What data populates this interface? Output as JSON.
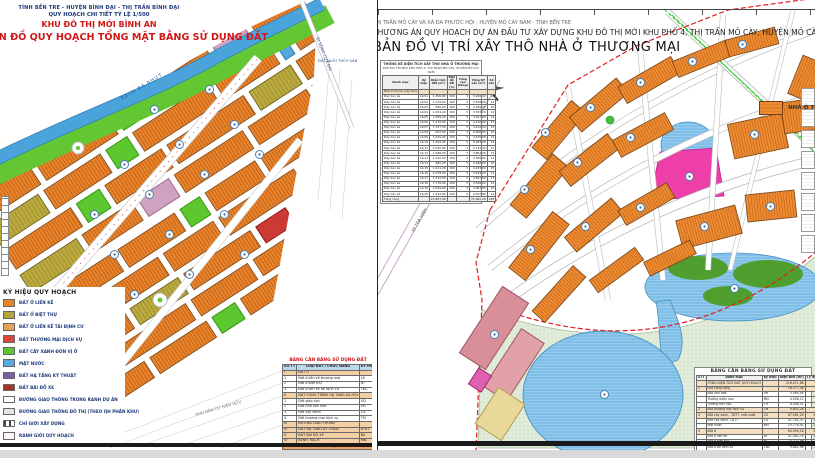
{
  "left_map": {
    "header": {
      "line1": "TỈNH BẾN TRE - HUYỆN BÌNH ĐẠI - THỊ TRẤN BÌNH ĐẠI",
      "line2": "QUY HOẠCH CHI TIẾT TỶ LỆ 1/500",
      "line3": "KHU ĐÔ THỊ MỚI BÌNH AN",
      "line4": "BẢN ĐỒ QUY HOẠCH TỔNG MẶT BẰNG SỬ DỤNG ĐẤT"
    },
    "labels": {
      "river": "RẠCH BÀ NHỰT",
      "road_top": "ĐI SÔNG CỬA ĐẠI",
      "aqua_land": "ĐẤT NUÔI THỦY SẢN",
      "existing": "KHU DÂN CƯ HIỆN HỮU"
    },
    "legend": {
      "title": "KÝ HIỆU QUY HOẠCH",
      "items": [
        {
          "label": "ĐẤT Ở LIỀN KỀ",
          "color": "#e8832b"
        },
        {
          "label": "ĐẤT Ở BIỆT THỰ",
          "color": "#b5a43c"
        },
        {
          "label": "ĐẤT Ở LIỀN KỀ TÁI ĐỊNH CƯ",
          "color": "#e6a258"
        },
        {
          "label": "ĐẤT THƯƠNG MẠI DỊCH VỤ",
          "color": "#d9483b"
        },
        {
          "label": "ĐẤT CÂY XANH ĐƠN VỊ Ở",
          "color": "#5cc72f"
        },
        {
          "label": "MẶT NƯỚC",
          "color": "#57a9dd"
        },
        {
          "label": "ĐẤT HẠ TẦNG KỸ THUẬT",
          "color": "#7c5fa8"
        },
        {
          "label": "ĐẤT BÃI ĐỖ XE",
          "color": "#a93226"
        },
        {
          "label": "ĐƯỜNG GIAO THÔNG TRONG RANH DỰ ÁN",
          "color": "#ffffff"
        },
        {
          "label": "ĐƯỜNG GIAO THÔNG ĐÔ THỊ (THEO QH PHÂN KHU)",
          "color": "#e4e4e4"
        },
        {
          "label": "CHỈ GIỚI XÂY DỰNG",
          "color": "repeating-linear-gradient(90deg,#444 0 2px,#fff 2px 5px)"
        },
        {
          "label": "RANH GIỚI QUY HOẠCH",
          "color": "#fff4f4"
        }
      ]
    },
    "table": {
      "title": "BẢNG CÂN BẰNG SỬ DỤNG ĐẤT",
      "headers": [
        "SỐ TT",
        "LOẠI ĐẤT / CHỨC NĂNG",
        "KÝ HIỆU"
      ],
      "rows": [
        {
          "tt": "I",
          "name": "ĐẤT Ở",
          "kh": "",
          "bg": "#f4cfa4"
        },
        {
          "tt": "1",
          "name": "Đất ở liền kề thương mại",
          "kh": "LK",
          "bg": ""
        },
        {
          "tt": "2",
          "name": "Đất ở biệt thự",
          "kh": "BT",
          "bg": ""
        },
        {
          "tt": "3",
          "name": "Đất ở liền kề tái định cư",
          "kh": "TĐC",
          "bg": ""
        },
        {
          "tt": "II",
          "name": "ĐẤT CÔNG TRÌNH HẠ TẦNG XÃ HỘI",
          "kh": "",
          "bg": "#f4cfa4"
        },
        {
          "tt": "1",
          "name": "Đất giáo dục",
          "kh": "GD",
          "bg": ""
        },
        {
          "tt": "2",
          "name": "Đất nhà văn hóa",
          "kh": "VH",
          "bg": ""
        },
        {
          "tt": "3",
          "name": "Đất cây xanh",
          "kh": "CX",
          "bg": ""
        },
        {
          "tt": "4",
          "name": "Đất thương mại dịch vụ",
          "kh": "TM",
          "bg": ""
        },
        {
          "tt": "III",
          "name": "ĐƯỜNG GIAO THÔNG",
          "kh": "",
          "bg": "#f4cfa4"
        },
        {
          "tt": "IV",
          "name": "ĐẤT HẠ TẦNG KỸ THUẬT",
          "kh": "HTKT",
          "bg": "#f4cfa4"
        },
        {
          "tt": "V",
          "name": "ĐẤT BÃI ĐỖ XE",
          "kh": "BX",
          "bg": "#f4cfa4"
        },
        {
          "tt": "VI",
          "name": "KÊNH, RẠCH",
          "kh": "MN",
          "bg": "#f4cfa4"
        }
      ],
      "footer": "TỔNG CỘNG"
    }
  },
  "right_map": {
    "header": {
      "line1": "THỊ TRẤN MỎ CÀY VÀ XÃ ĐA PHƯỚC HỘI - HUYỆN MỎ CÀY NAM - TỈNH BẾN TRE",
      "line2": "PHƯƠNG ÁN QUY HOẠCH DỰ ÁN ĐẦU TƯ XÂY DỰNG KHU ĐÔ THỊ MỚI KHU PHỐ 4, THỊ TRẤN MỎ CÀY, HUYỆN MỎ CÀY NAM",
      "line3": "BẢN ĐỒ VỊ TRÍ XÂY THÔ NHÀ Ở THƯƠNG MẠI"
    },
    "legend_label": "NHÀ Ở THƯƠNG MẠI",
    "road_label": "ĐI TÒA VỊNH",
    "top_table": {
      "caption1": "THỐNG KÊ DIỆN TÍCH XÂY THÔ NHÀ Ở THƯƠNG MẠI",
      "caption2": "KHU ĐÔ THỊ MỚI KHU PHỐ 4, THỊ TRẤN MỎ CÀY, HUYỆN MỎ CÀY NAM",
      "headers": [
        "Danh mục",
        "Ký hiệu",
        "Diện tích đất (m²)",
        "Mật độ XD (%)",
        "Tầng cao (tầng)",
        "Tổng DT sàn (m²)",
        "Số căn"
      ],
      "rows": [
        {
          "name": "Nhà ở liền kề (xây thô)",
          "kh": "",
          "dt": "",
          "md": "",
          "tc": "",
          "san": "",
          "can": "",
          "bg": "#f0e0c8"
        },
        {
          "name": "Dãy liền kề",
          "kh": "LK-01",
          "dt": "1.306,80",
          "md": "100",
          "tc": "3",
          "san": "3.920,40",
          "can": "13",
          "bg": ""
        },
        {
          "name": "Dãy liền kề",
          "kh": "LK-02",
          "dt": "1.176,00",
          "md": "100",
          "tc": "3",
          "san": "3.528,00",
          "can": "12",
          "bg": ""
        },
        {
          "name": "Dãy liền kề",
          "kh": "LK-03",
          "dt": "980,00",
          "md": "100",
          "tc": "3",
          "san": "2.940,00",
          "can": "10",
          "bg": ""
        },
        {
          "name": "Dãy liền kề",
          "kh": "LK-04",
          "dt": "1.254,40",
          "md": "100",
          "tc": "3",
          "san": "3.763,20",
          "can": "14",
          "bg": ""
        },
        {
          "name": "Dãy liền kề",
          "kh": "LK-05",
          "dt": "1.089,20",
          "md": "100",
          "tc": "3",
          "san": "3.267,60",
          "can": "11",
          "bg": ""
        },
        {
          "name": "Dãy liền kề",
          "kh": "LK-06",
          "dt": "1.470,00",
          "md": "100",
          "tc": "3",
          "san": "4.410,00",
          "can": "15",
          "bg": ""
        },
        {
          "name": "Dãy liền kề",
          "kh": "LK-07",
          "dt": "1.137,50",
          "md": "100",
          "tc": "3",
          "san": "3.412,50",
          "can": "12",
          "bg": ""
        },
        {
          "name": "Dãy liền kề",
          "kh": "LK-08",
          "dt": "952,00",
          "md": "100",
          "tc": "3",
          "san": "2.856,00",
          "can": "10",
          "bg": ""
        },
        {
          "name": "Dãy liền kề",
          "kh": "LK-09",
          "dt": "1.225,00",
          "md": "100",
          "tc": "3",
          "san": "3.675,00",
          "can": "13",
          "bg": ""
        },
        {
          "name": "Dãy liền kề",
          "kh": "LK-10",
          "dt": "1.394,40",
          "md": "100",
          "tc": "3",
          "san": "4.183,20",
          "can": "14",
          "bg": ""
        },
        {
          "name": "Dãy liền kề",
          "kh": "LK-11",
          "dt": "1.045,80",
          "md": "100",
          "tc": "3",
          "san": "3.137,40",
          "can": "11",
          "bg": ""
        },
        {
          "name": "Dãy liền kề",
          "kh": "LK-12",
          "dt": "1.288,00",
          "md": "100",
          "tc": "3",
          "san": "3.864,00",
          "can": "13",
          "bg": ""
        },
        {
          "name": "Dãy liền kề",
          "kh": "LK-13",
          "dt": "1.120,00",
          "md": "100",
          "tc": "3",
          "san": "3.360,00",
          "can": "12",
          "bg": ""
        },
        {
          "name": "Dãy liền kề",
          "kh": "LK-14",
          "dt": "980,00",
          "md": "100",
          "tc": "3",
          "san": "2.940,00",
          "can": "10",
          "bg": ""
        },
        {
          "name": "Dãy liền kề",
          "kh": "LK-15",
          "dt": "1.411,20",
          "md": "100",
          "tc": "3",
          "san": "4.233,60",
          "can": "15",
          "bg": ""
        },
        {
          "name": "Dãy liền kề",
          "kh": "LK-16",
          "dt": "1.078,00",
          "md": "100",
          "tc": "3",
          "san": "3.234,00",
          "can": "11",
          "bg": ""
        },
        {
          "name": "Dãy liền kề",
          "kh": "LK-17",
          "dt": "1.232,50",
          "md": "100",
          "tc": "3",
          "san": "3.697,50",
          "can": "13",
          "bg": ""
        },
        {
          "name": "Dãy liền kề",
          "kh": "LK-18",
          "dt": "1.176,00",
          "md": "100",
          "tc": "3",
          "san": "3.528,00",
          "can": "12",
          "bg": ""
        },
        {
          "name": "Dãy liền kề",
          "kh": "LK-19",
          "dt": "1.029,00",
          "md": "100",
          "tc": "3",
          "san": "3.087,00",
          "can": "10",
          "bg": ""
        },
        {
          "name": "Dãy liền kề",
          "kh": "LK-20",
          "dt": "1.342,60",
          "md": "100",
          "tc": "3",
          "san": "4.027,80",
          "can": "14",
          "bg": ""
        },
        {
          "name": "Tổng cộng",
          "kh": "",
          "dt": "23.687,40",
          "md": "",
          "tc": "",
          "san": "71.062,20",
          "can": "245",
          "bg": "#efefef"
        }
      ]
    },
    "bottom_table": {
      "title": "BẢNG CÂN BẰNG SỬ DỤNG ĐẤT",
      "headers": [
        "STT",
        "Danh mục",
        "Ký hiệu",
        "Diện tích (m²)",
        "Tỷ lệ (%)"
      ],
      "rows": [
        {
          "stt": "",
          "name": "TỔNG DIỆN TÍCH ĐẤT QUY HOẠCH",
          "kh": "",
          "dt": "216.471,68",
          "tl": "100",
          "bg": "#f3dfc0"
        },
        {
          "stt": "1",
          "name": "Đất công cộng",
          "kh": "",
          "dt": "16.377,08",
          "tl": "7,56",
          "bg": "#f3dfc0"
        },
        {
          "stt": "",
          "name": "Đất văn hóa",
          "kh": "VH",
          "dt": "3.560,45",
          "tl": "1,64",
          "bg": ""
        },
        {
          "stt": "",
          "name": "Trường mầm non",
          "kh": "MN",
          "dt": "4.508,12",
          "tl": "2,08",
          "bg": ""
        },
        {
          "stt": "",
          "name": "Trường tiểu học",
          "kh": "TH",
          "dt": "8.308,51",
          "tl": "3,84",
          "bg": ""
        },
        {
          "stt": "2",
          "name": "Đất thương mại dịch vụ",
          "kh": "TM",
          "dt": "9.643,28",
          "tl": "4,45",
          "bg": "#f3dfc0"
        },
        {
          "stt": "3",
          "name": "Đất cây xanh - TDTT, mặt nước",
          "kh": "CX",
          "dt": "67.561,29",
          "tl": "31,21",
          "bg": "#f3dfc0"
        },
        {
          "stt": "",
          "name": "Đất cây xanh, TDTT",
          "kh": "CX",
          "dt": "41.782,37",
          "tl": "19,30",
          "bg": ""
        },
        {
          "stt": "",
          "name": "Mặt nước",
          "kh": "MN",
          "dt": "25.778,92",
          "tl": "11,91",
          "bg": ""
        },
        {
          "stt": "4",
          "name": "Đất ở",
          "kh": "",
          "dt": "64.994,16",
          "tl": "30,02",
          "bg": "#f3dfc0"
        },
        {
          "stt": "",
          "name": "Đất ở liền kề",
          "kh": "LK",
          "dt": "41.583,74",
          "tl": "19,21",
          "bg": ""
        },
        {
          "stt": "",
          "name": "Đất ở biệt thự",
          "kh": "BT",
          "dt": "13.727,46",
          "tl": "6,34",
          "bg": ""
        },
        {
          "stt": "",
          "name": "Đất ở tái định cư",
          "kh": "TĐC",
          "dt": "9.682,96",
          "tl": "4,47",
          "bg": ""
        },
        {
          "stt": "5",
          "name": "Đất hạ tầng kỹ thuật",
          "kh": "HTKT",
          "dt": "1.496,32",
          "tl": "0,69",
          "bg": "#f3dfc0"
        },
        {
          "stt": "6",
          "name": "Đất giao thông",
          "kh": "",
          "dt": "56.399,55",
          "tl": "26,07",
          "bg": "#f3dfc0"
        }
      ]
    }
  }
}
